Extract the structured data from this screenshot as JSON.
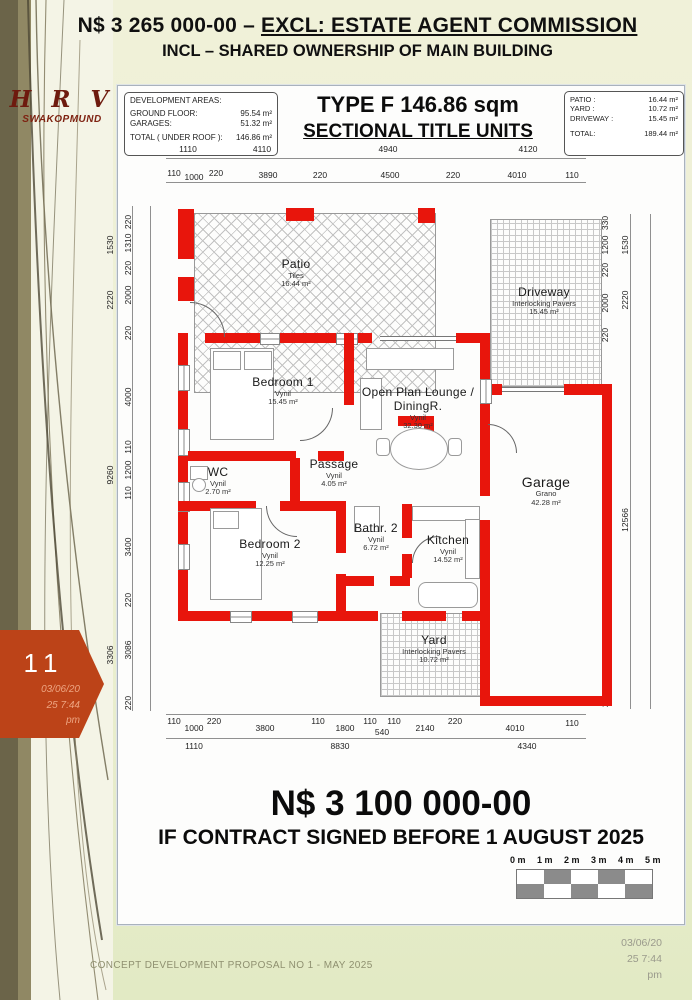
{
  "header": {
    "price_prefix": "N$ 3 265 000-00 – ",
    "price_suffix_underlined": "EXCL: ESTATE AGENT COMMISSION",
    "line2": "INCL – SHARED OWNERSHIP OF MAIN BUILDING"
  },
  "logo": {
    "title": "H R V",
    "subtitle": "SWAKOPMUND"
  },
  "sheet": {
    "dev_areas": {
      "title": "DEVELOPMENT AREAS:",
      "rows": [
        {
          "label": "GROUND FLOOR:",
          "value": "95.54 m²"
        },
        {
          "label": "GARAGES:",
          "value": "51.32 m²"
        }
      ],
      "total_label": "TOTAL ( UNDER ROOF ):",
      "total_value": "146.86 m²"
    },
    "title1": "TYPE F 146.86 sqm",
    "title2": "SECTIONAL TITLE UNITS",
    "ext_areas": {
      "rows": [
        {
          "label": "PATIO :",
          "value": "16.44 m²"
        },
        {
          "label": "YARD :",
          "value": "10.72 m²"
        },
        {
          "label": "DRIVEWAY :",
          "value": "15.45 m²"
        }
      ],
      "total_label": "TOTAL:",
      "total_value": "189.44 m²"
    }
  },
  "plan": {
    "rooms": [
      {
        "name": "Patio",
        "finish": "Tiles",
        "area": "16.44 m²"
      },
      {
        "name": "Driveway",
        "finish": "Interlocking Pavers",
        "area": "15.45 m²"
      },
      {
        "name": "Bedroom 1",
        "finish": "Vynil",
        "area": "15.45 m²"
      },
      {
        "name": "Open Plan Lounge / DiningR.",
        "finish": "Vynil",
        "area": "32.30 m²"
      },
      {
        "name": "WC",
        "finish": "Vynil",
        "area": "2.70 m²"
      },
      {
        "name": "Passage",
        "finish": "Vynil",
        "area": "4.05 m²"
      },
      {
        "name": "Bedroom 2",
        "finish": "Vynil",
        "area": "12.25 m²"
      },
      {
        "name": "Bathr. 2",
        "finish": "Vynil",
        "area": "6.72 m²"
      },
      {
        "name": "Kitchen",
        "finish": "Vynil",
        "area": "14.52 m²"
      },
      {
        "name": "Garage",
        "finish": "Grano",
        "area": "42.28 m²"
      },
      {
        "name": "Yard",
        "finish": "Interlocking Pavers",
        "area": "10.72 m²"
      }
    ]
  },
  "dims": {
    "top1": [
      "1110",
      "4110",
      "4940",
      "4120"
    ],
    "top2": [
      "110",
      "1000",
      "220",
      "3890",
      "220",
      "4500",
      "220",
      "4010",
      "110"
    ],
    "bottom1": [
      "110",
      "1000",
      "220",
      "3800",
      "110",
      "1800",
      "110",
      "110",
      "540",
      "2140",
      "220",
      "4010",
      "110"
    ],
    "bottom2": [
      "1110",
      "8830",
      "4340"
    ],
    "left_outer": [
      "1530",
      "2220",
      "9260",
      "3306"
    ],
    "left_inner": [
      "220",
      "1310",
      "220",
      "2000",
      "220",
      "4000",
      "110",
      "1200",
      "110",
      "3400",
      "220",
      "3086",
      "220"
    ],
    "right_inner": [
      "330",
      "1200",
      "220",
      "2000",
      "220",
      "12126",
      "220"
    ],
    "right_outer": [
      "1530",
      "2220",
      "12566"
    ]
  },
  "price": {
    "amount": "N$ 3 100 000-00",
    "condition": "IF CONTRACT SIGNED BEFORE 1 AUGUST 2025"
  },
  "scalebar": {
    "labels": [
      "0 m",
      "1 m",
      "2 m",
      "3 m",
      "4 m",
      "5 m"
    ]
  },
  "badge": {
    "number": "11",
    "date_lines": [
      "03/06/20",
      "25 7:44",
      "pm"
    ]
  },
  "footer": {
    "left": "CONCEPT DEVELOPMENT PROPOSAL NO 1 - MAY 2025",
    "right_lines": [
      "03/06/20",
      "25 7:44",
      "pm"
    ]
  }
}
